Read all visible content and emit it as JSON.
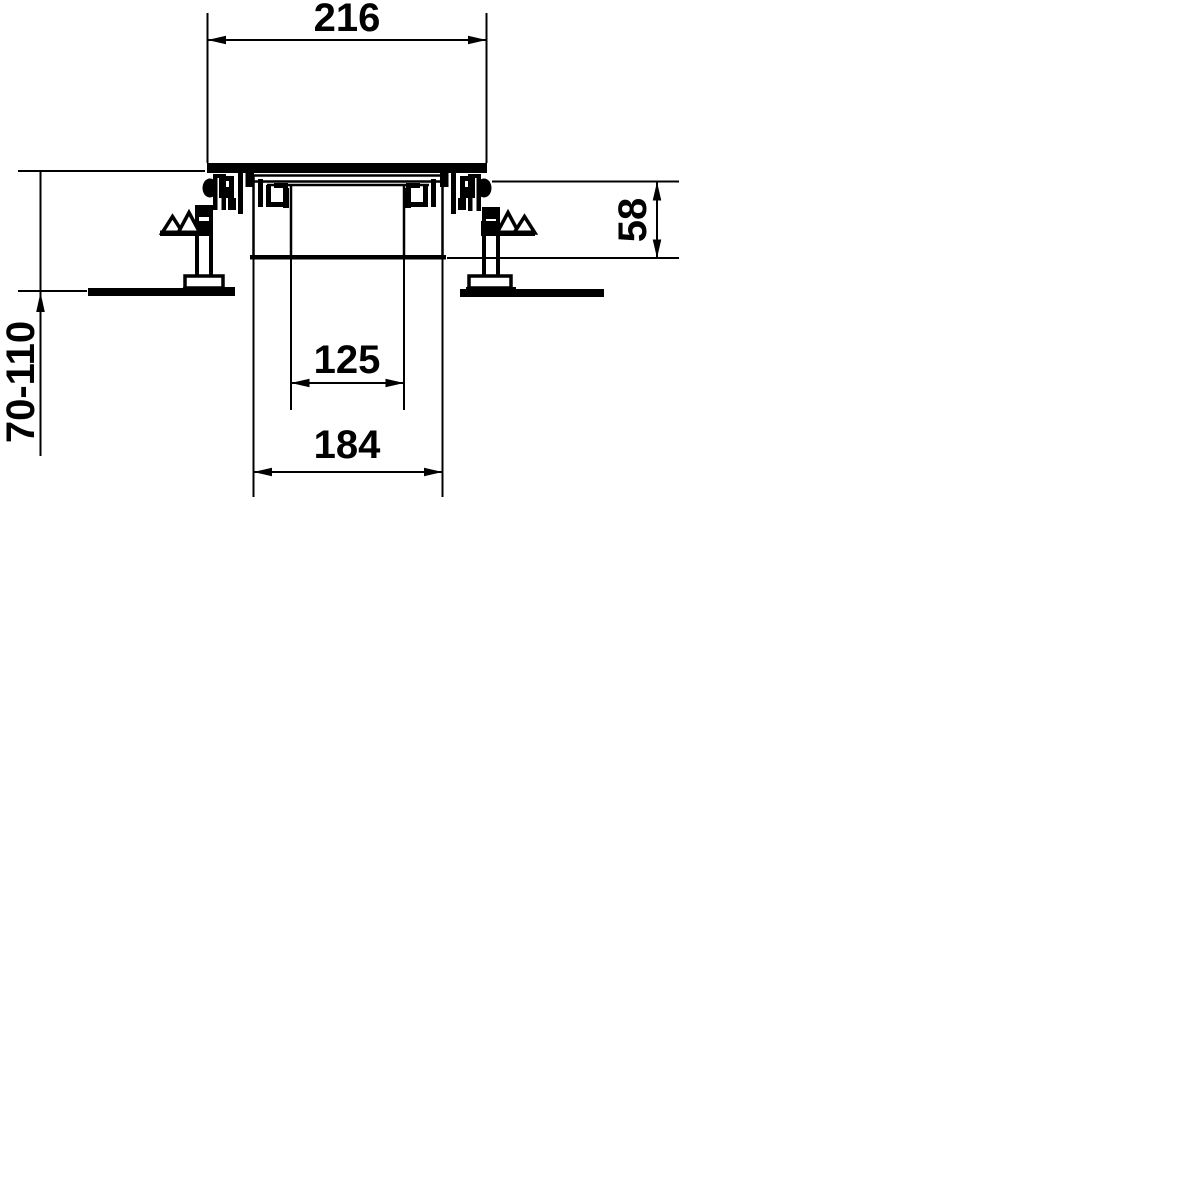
{
  "document": {
    "background_color": "#ffffff",
    "line_color": "#000000"
  },
  "drawing": {
    "dim_cover_width": "216",
    "dim_box_depth": "58",
    "dim_height_range": "70-110",
    "dim_inner_opening": "125",
    "dim_outer_opening": "184"
  }
}
